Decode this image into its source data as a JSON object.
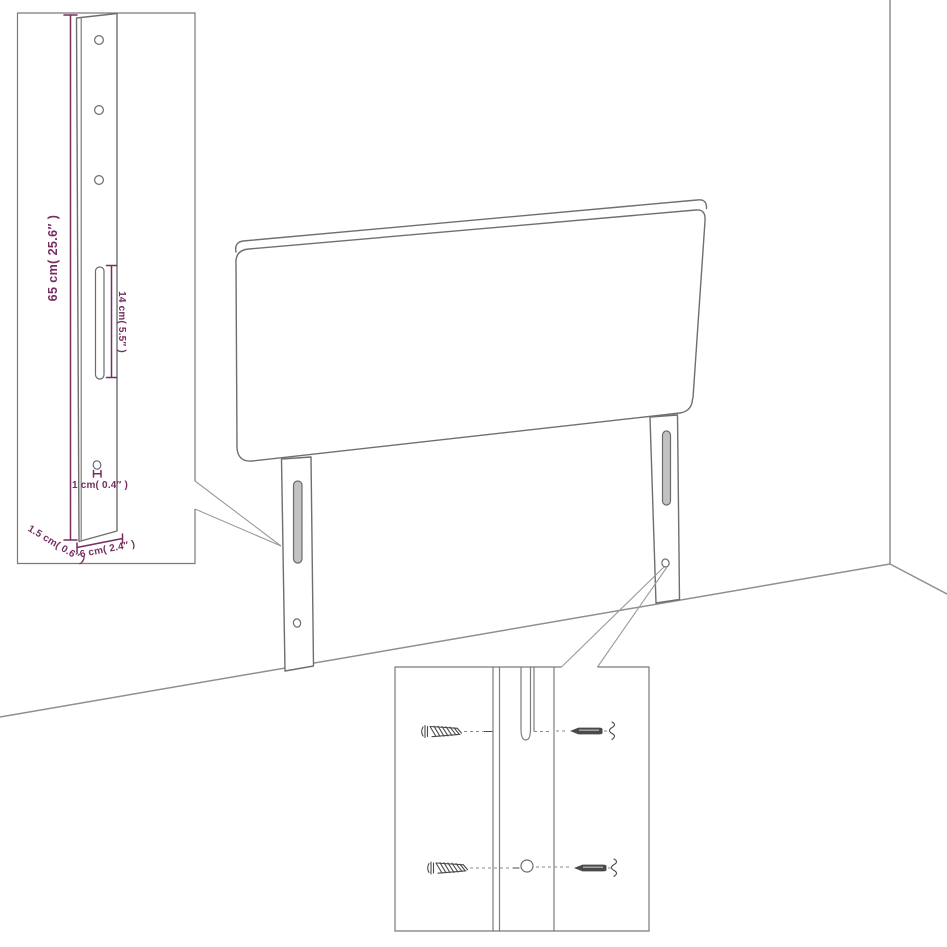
{
  "diagram": {
    "colors": {
      "dimension_text": "#772d62",
      "drawing_line": "#6f6f6f",
      "room_line": "#8f8f8f"
    },
    "bracket_detail": {
      "height_label": "65 cm( 25.6″ )",
      "slot_label": "14 cm( 5.5″ )",
      "hole_label": "1 cm( 0.4″ )",
      "thickness_label": "1.5 cm( 0.6″ )",
      "width_label": "6 cm( 2.4″ )"
    }
  }
}
